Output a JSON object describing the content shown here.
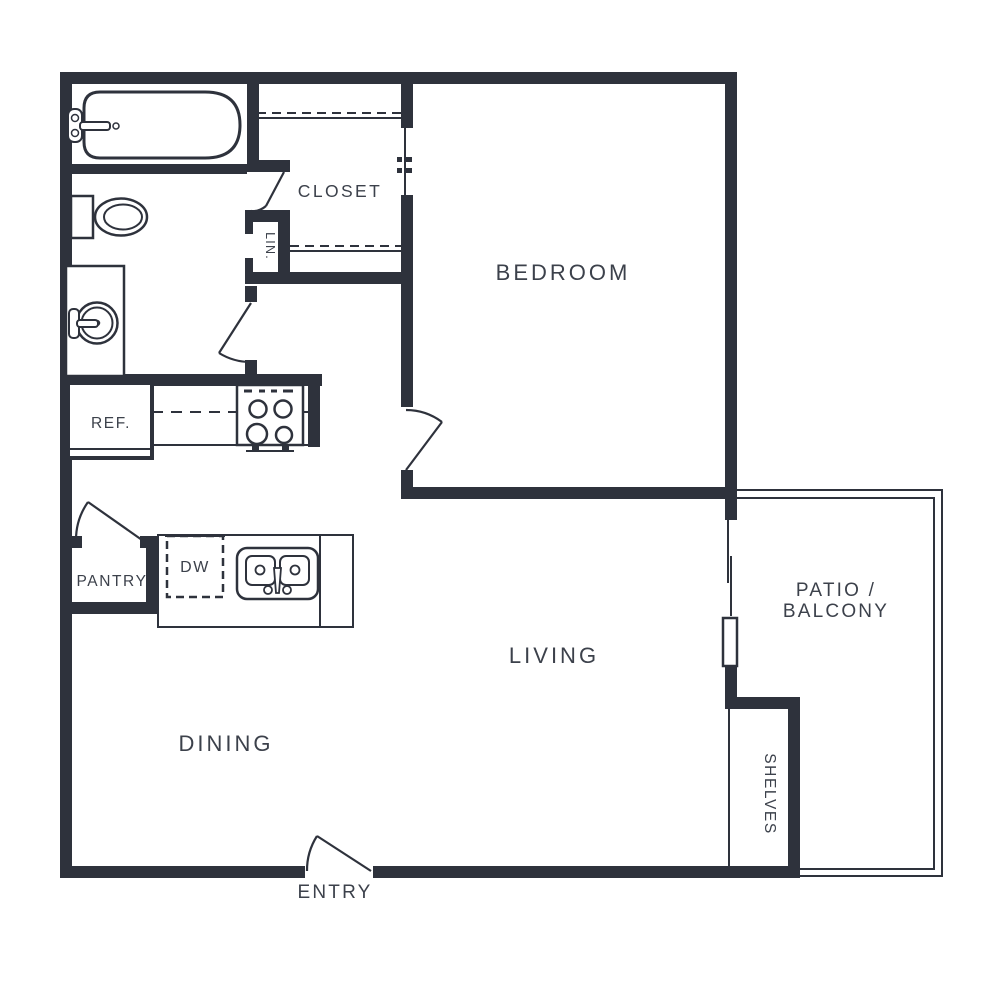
{
  "colors": {
    "wall": "#2e323c",
    "text": "#3c414b"
  },
  "rooms": {
    "bedroom": {
      "label": "BEDROOM"
    },
    "closet": {
      "label": "CLOSET"
    },
    "linen": {
      "label": "LIN."
    },
    "living": {
      "label": "LIVING"
    },
    "dining": {
      "label": "DINING"
    },
    "pantry": {
      "label": "PANTRY"
    },
    "entry": {
      "label": "ENTRY"
    },
    "shelves": {
      "label": "SHELVES"
    },
    "patio": {
      "label_line1": "PATIO /",
      "label_line2": "BALCONY"
    }
  },
  "fixtures": {
    "refrigerator": {
      "label": "REF."
    },
    "dishwasher": {
      "label": "DW"
    }
  }
}
